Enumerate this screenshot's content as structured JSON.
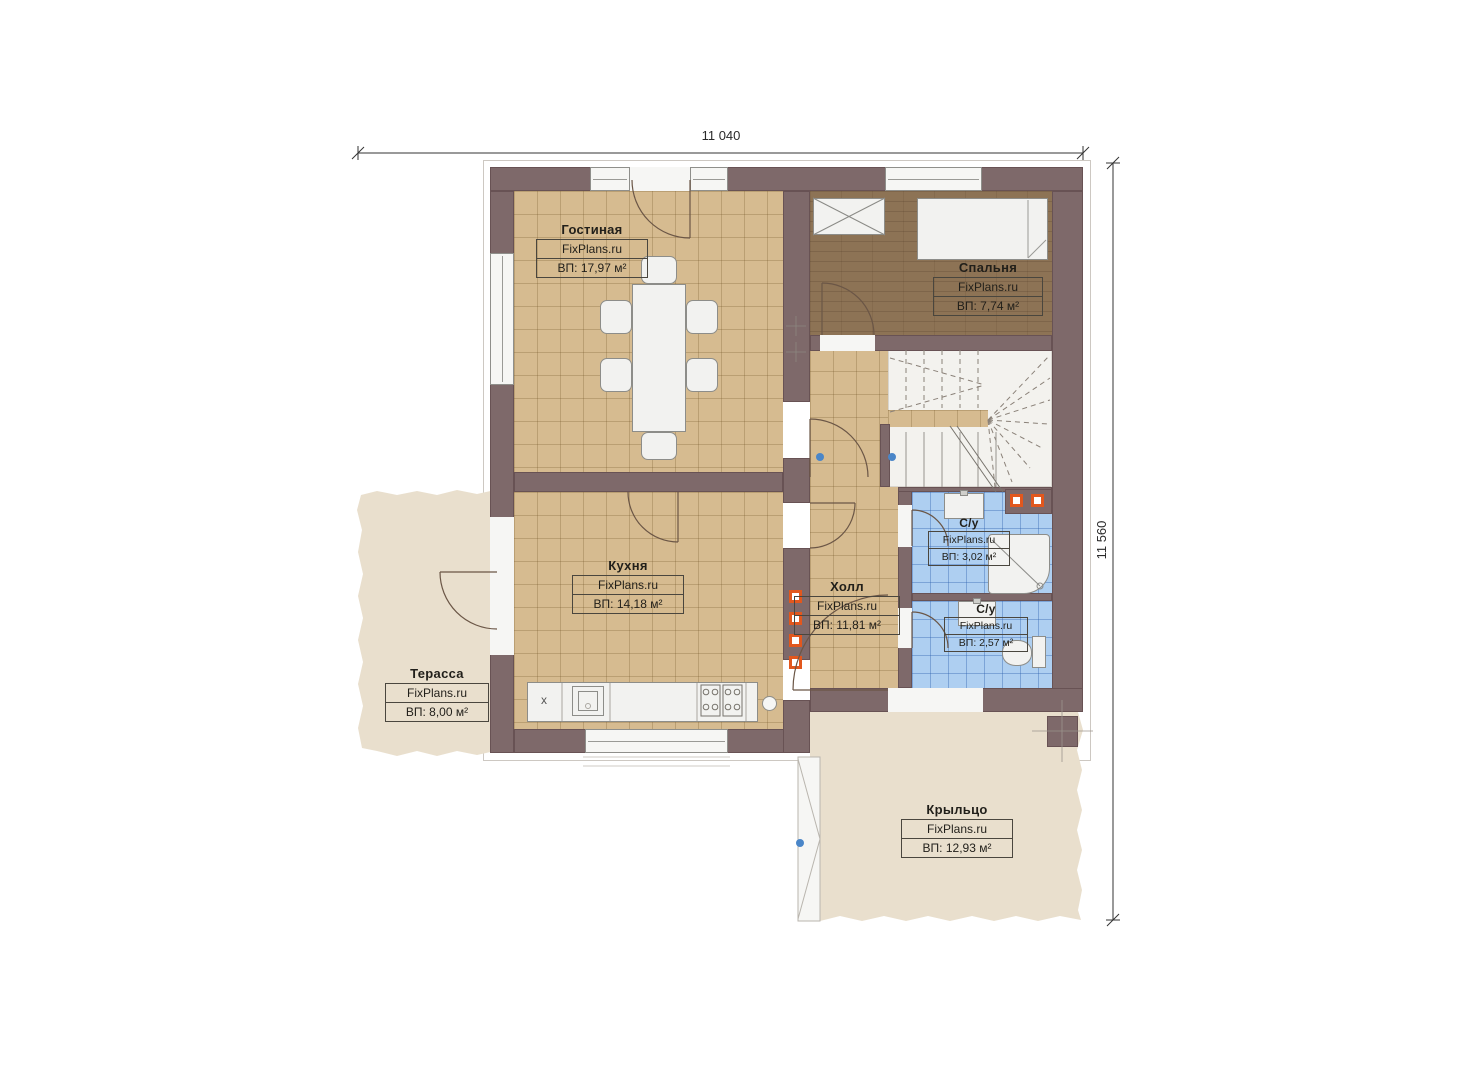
{
  "site": "FixPlans.ru",
  "dimensions": {
    "top": "11 040",
    "right": "11 560"
  },
  "rooms": {
    "living": {
      "name": "Гостиная",
      "brand": "FixPlans.ru",
      "area": "ВП: 17,97 м²"
    },
    "bedroom": {
      "name": "Спальня",
      "brand": "FixPlans.ru",
      "area": "ВП: 7,74 м²"
    },
    "kitchen": {
      "name": "Кухня",
      "brand": "FixPlans.ru",
      "area": "ВП: 14,18 м²"
    },
    "hall": {
      "name": "Холл",
      "brand": "FixPlans.ru",
      "area": "ВП: 11,81 м²"
    },
    "bath1": {
      "name": "С/у",
      "brand": "FixPlans.ru",
      "area": "ВП: 3,02 м²"
    },
    "bath2": {
      "name": "С/у",
      "brand": "FixPlans.ru",
      "area": "ВП: 2,57 м²"
    },
    "terrace": {
      "name": "Терасса",
      "brand": "FixPlans.ru",
      "area": "ВП: 8,00 м²"
    },
    "porch": {
      "name": "Крыльцо",
      "brand": "FixPlans.ru",
      "area": "ВП: 12,93 м²"
    }
  },
  "fixtures": {
    "x_mark": "x"
  },
  "palette": {
    "wall": "#7e696a",
    "floor_tile": "#d6bb90",
    "bedroom_wood": "#8d7355",
    "bathroom_tile": "#aecff1",
    "outdoor_deck": "#e9dfcd",
    "accent_orange": "#e2571d",
    "marker_blue": "#4a86c8"
  }
}
